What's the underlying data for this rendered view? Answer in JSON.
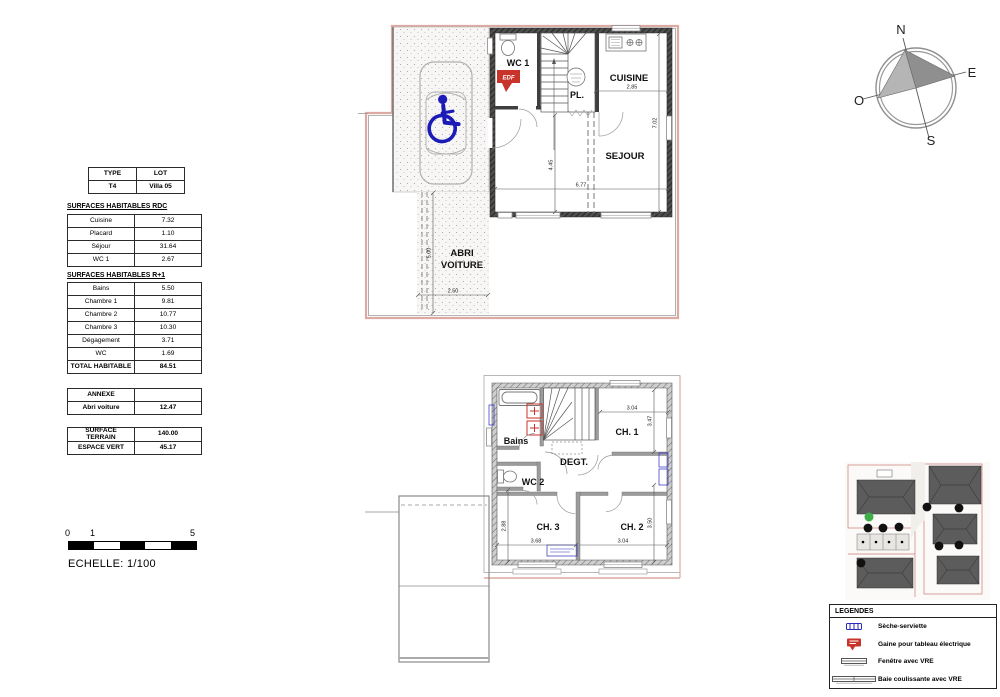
{
  "doc": {
    "lot_table": {
      "headers": [
        "TYPE",
        "LOT"
      ],
      "values": [
        "T4",
        "Villa 05"
      ]
    },
    "rdc_table": {
      "title": "SURFACES HABITABLES RDC",
      "rows": [
        {
          "label": "Cuisine",
          "value": "7.32"
        },
        {
          "label": "Placard",
          "value": "1.10"
        },
        {
          "label": "Séjour",
          "value": "31.64"
        },
        {
          "label": "WC 1",
          "value": "2.67"
        }
      ]
    },
    "r1_table": {
      "title": "SURFACES HABITABLES R+1",
      "rows": [
        {
          "label": "Bains",
          "value": "5.50"
        },
        {
          "label": "Chambre 1",
          "value": "9.81"
        },
        {
          "label": "Chambre 2",
          "value": "10.77"
        },
        {
          "label": "Chambre 3",
          "value": "10.30"
        },
        {
          "label": "Dégagement",
          "value": "3.71"
        },
        {
          "label": "WC",
          "value": "1.69"
        }
      ],
      "total_label": "TOTAL HABITABLE",
      "total_value": "84.51"
    },
    "annexe_table": {
      "header": "ANNEXE",
      "row_label": "Abri voiture",
      "row_value": "12.47"
    },
    "terrain_table": {
      "rows": [
        {
          "label": "SURFACE TERRAIN",
          "value": "140.00"
        },
        {
          "label": "ESPACE VERT",
          "value": "45.17"
        }
      ]
    },
    "scale": {
      "label": "ECHELLE: 1/100",
      "ticks": [
        "0",
        "1",
        "5"
      ]
    },
    "compass": {
      "n": "N",
      "e": "E",
      "s": "S",
      "w": "O"
    }
  },
  "rdc_plan": {
    "labels": {
      "wc1": "WC 1",
      "pl": "PL.",
      "cuisine": "CUISINE",
      "sejour": "SEJOUR",
      "abri_line1": "ABRI",
      "abri_line2": "VOITURE",
      "edf": "EDF"
    },
    "dims": {
      "cuisine_w": "2.85",
      "right_h": "7.02",
      "hall_h": "4.45",
      "sejour_w": "6.77",
      "abri_w": "2.50",
      "abri_h": "5.00"
    }
  },
  "r1_plan": {
    "labels": {
      "bains": "Bains",
      "degt": "DEGT.",
      "wc2": "WC 2",
      "ch1": "CH. 1",
      "ch2": "CH. 2",
      "ch3": "CH. 3"
    },
    "dims": {
      "ch1_w": "3.04",
      "ch1_h": "3.47",
      "ch2_h": "3.50",
      "ch3_h": "2.88",
      "ch3_w": "3.68",
      "ch2_w": "3.04"
    }
  },
  "legend": {
    "title": "LEGENDES",
    "items": [
      "Sèche-serviette",
      "Gaine pour tableau électrique",
      "Fenêtre avec VRE",
      "Baie coulissante avec VRE"
    ]
  },
  "colors": {
    "boundary_pink": "#dcaaa3",
    "wall_dark": "#4e4e4e",
    "wall_gray": "#cfcfcf",
    "accent_blue": "#1b1bb8",
    "accent_red": "#c8332b",
    "tree_green": "#3fae49"
  }
}
